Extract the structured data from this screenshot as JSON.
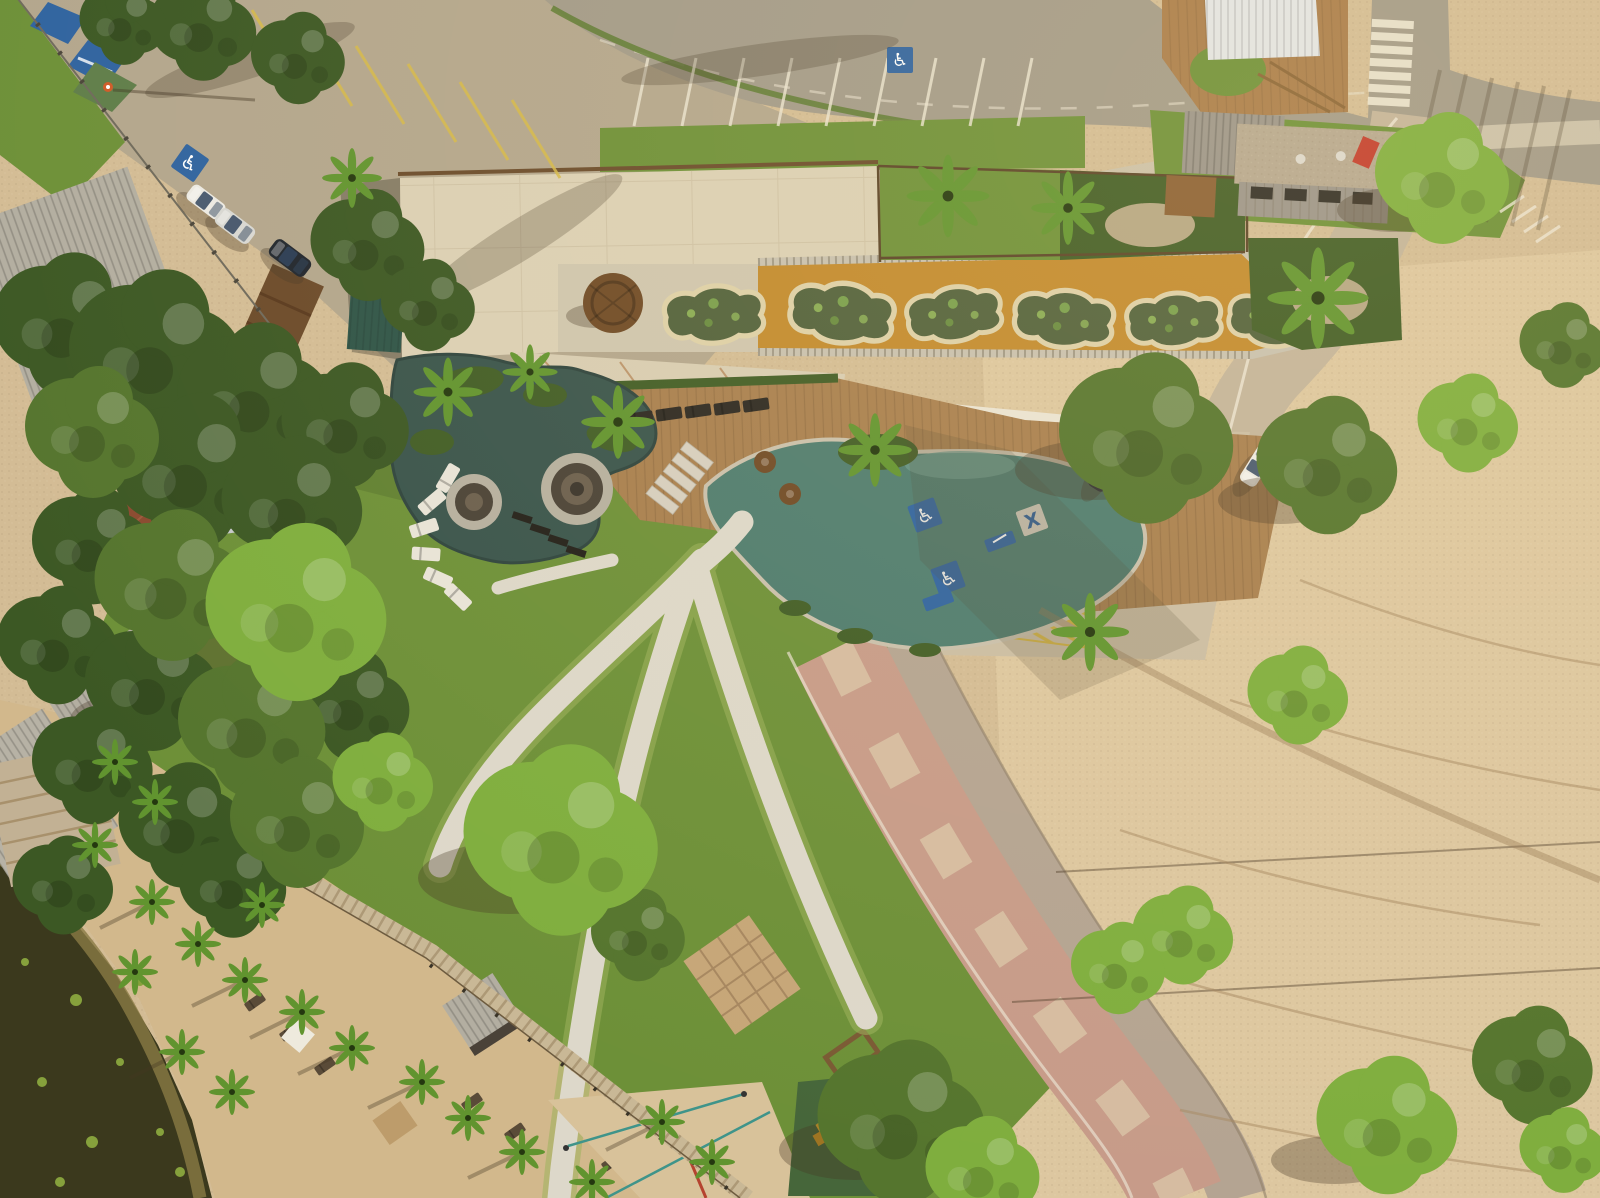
{
  "scene": {
    "title": "Aerial drone view — beachfront leisure club with rooftop planter deck, organic pools, lawn paths, lagoon beach and cleared sand lot",
    "view": "top-down",
    "lighting": "late afternoon, long shadows toward lower-left"
  },
  "palette": {
    "sand_base": "#d3bc95",
    "sand_bright": "#e0cba4",
    "cobble": "#b3a68d",
    "asphalt": "#a29a89",
    "sidewalk": "#cbc1aa",
    "sand_road": "#c3b49b",
    "grass": "#6d9038",
    "grass_dark": "#4f6b2a",
    "hedge": "#415d26",
    "tree_dark": "#3c5824",
    "tree_mid": "#55752e",
    "tree_bright": "#7fae3e",
    "palm": "#61942f",
    "lake": "#3b391d",
    "lake_shore": "#8a7a45",
    "roof_concrete": "#dbd0b5",
    "courtyard_stone": "#cfc6af",
    "deck_orange": "#c28a2e",
    "planter_soil": "#51613c",
    "stone_wall": "#c8c1b0",
    "canopy_white": "#eae4d5",
    "canopy_bright": "#f4f0e5",
    "wood_deck": "#a87f4f",
    "parasol_brown": "#6f4a26",
    "pool_upper": "#39544c",
    "pool_lower": "#4e7c6f",
    "spa_ring": "#b6b0a0",
    "path_white": "#ddd8ca",
    "path_edge": "#9db25c",
    "promenade_pink": "#c79b89",
    "promenade_wave": "#dac4a7",
    "road_gray": "#b4a492",
    "beach_sand": "#d2b88c",
    "boardwalk": "#c9b896",
    "court_sand": "#d8c29a",
    "court_line": "#3f948a",
    "court_line_red": "#b5432f",
    "rubber_green": "#46663a",
    "play_yellow": "#d9a62a",
    "marking_yellow": "#d6b94a",
    "marking_white": "#ece5d2",
    "sign_blue": "#2f63a0",
    "sign_red": "#c23b2c",
    "car_white": "#eceae4",
    "car_silver": "#d8d8d4",
    "car_dark": "#20262e",
    "metal_roof": "#c7c9cb",
    "tile_roof": "#8a4a30",
    "shed_gray": "#b3aea1",
    "teal_roof": "#2e5448",
    "pergola_wood": "#a97c4a",
    "white_ridge_roof": "#e2e5e7",
    "gravel_roof": "#b5a790",
    "shadow": "rgba(70,55,35,0.33)"
  },
  "icons": {
    "wheelchair": "♿",
    "cross": "X"
  },
  "inventory": {
    "cars_upper_lot": 3,
    "cars_lower_lot": 2,
    "cars_on_road": 1,
    "rooftop_planters": 6,
    "accessible_stall_markings": 5,
    "pools": 2,
    "spa_circles": 2,
    "white_sun_loungers": 6,
    "deck_loungers": 5,
    "crosswalk_stripes": 7,
    "playground": "yellow play structure on green rubber pad",
    "sports_court": "sand court with teal boundary lines",
    "lake": "dark lagoon at bottom-left",
    "construction_area": "cleared sand lot with tire tracks, right half"
  }
}
